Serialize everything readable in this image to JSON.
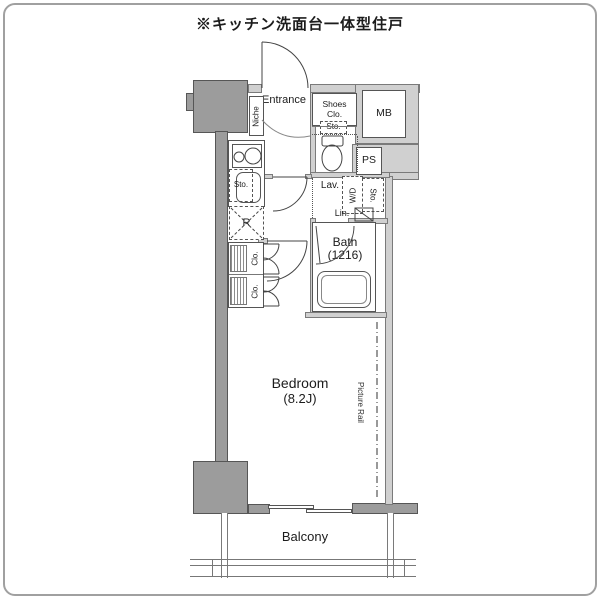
{
  "title": "※キッチン洗面台一体型住戸",
  "labels": {
    "entrance": "Entrance",
    "niche": "Niche",
    "shoes_closet": "Shoes Clo.",
    "meter_box": "MB",
    "pipe_space": "PS",
    "toilet_storage": "Sto.",
    "kitchen_storage": "Sto.",
    "refrigerator": "R",
    "lavatory": "Lav.",
    "washer_dryer": "W/D",
    "lavatory_storage": "Sto.",
    "linen": "Lin.",
    "bath_name": "Bath",
    "bath_size": "(1216)",
    "closet_upper": "Clo.",
    "closet_lower": "Clo.",
    "bedroom_name": "Bedroom",
    "bedroom_size": "(8.2J)",
    "picture_rail": "Picture Rail",
    "balcony": "Balcony"
  },
  "colors": {
    "column_gray": "#9c9c9c",
    "wall_gray": "#d0d0d0",
    "line": "#444444",
    "text": "#1c1c1c",
    "frame": "#a0a0a0",
    "background": "#ffffff"
  }
}
